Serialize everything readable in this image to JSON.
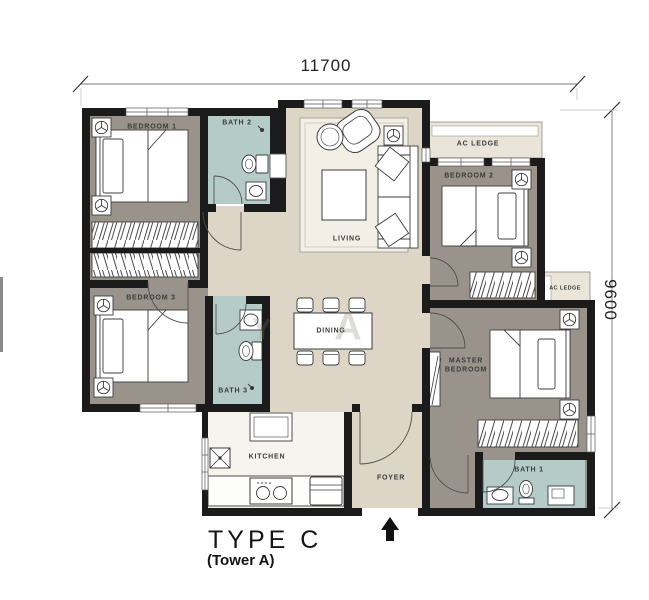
{
  "title": {
    "type_label": "TYPE  C",
    "tower_label": "(Tower A)"
  },
  "dimensions": {
    "width_mm": "11700",
    "height_mm": "9600"
  },
  "rooms": {
    "bedroom1": "BEDROOM 1",
    "bath2": "BATH 2",
    "living": "LIVING",
    "ac_ledge_top": "AC LEDGE",
    "bedroom2": "BEDROOM 2",
    "ac_ledge_right": "AC LEDGE",
    "bedroom3": "BEDROOM 3",
    "bath3": "BATH 3",
    "dining": "DINING",
    "master_line1": "MASTER",
    "master_line2": "BEDROOM",
    "kitchen": "KITCHEN",
    "foyer": "FOYER",
    "bath1": "BATH 1"
  },
  "watermark": {
    "letter1": "Y",
    "letter2": "A"
  },
  "icons": {
    "entrance_arrow": "up-arrow-entrance",
    "aircon_unit": "fan-symbol",
    "floor_drain": "x-box-drain"
  },
  "colors": {
    "wall": "#1b1b1b",
    "floor_bedroom": "#9a938b",
    "floor_living": "#ddd5c5",
    "floor_bath": "#b5cbc8",
    "floor_ledge": "#eae5d8",
    "floor_kitchen": "#f6f4ef",
    "furniture_stroke": "#3c3c3c",
    "dim_line": "#555555"
  }
}
